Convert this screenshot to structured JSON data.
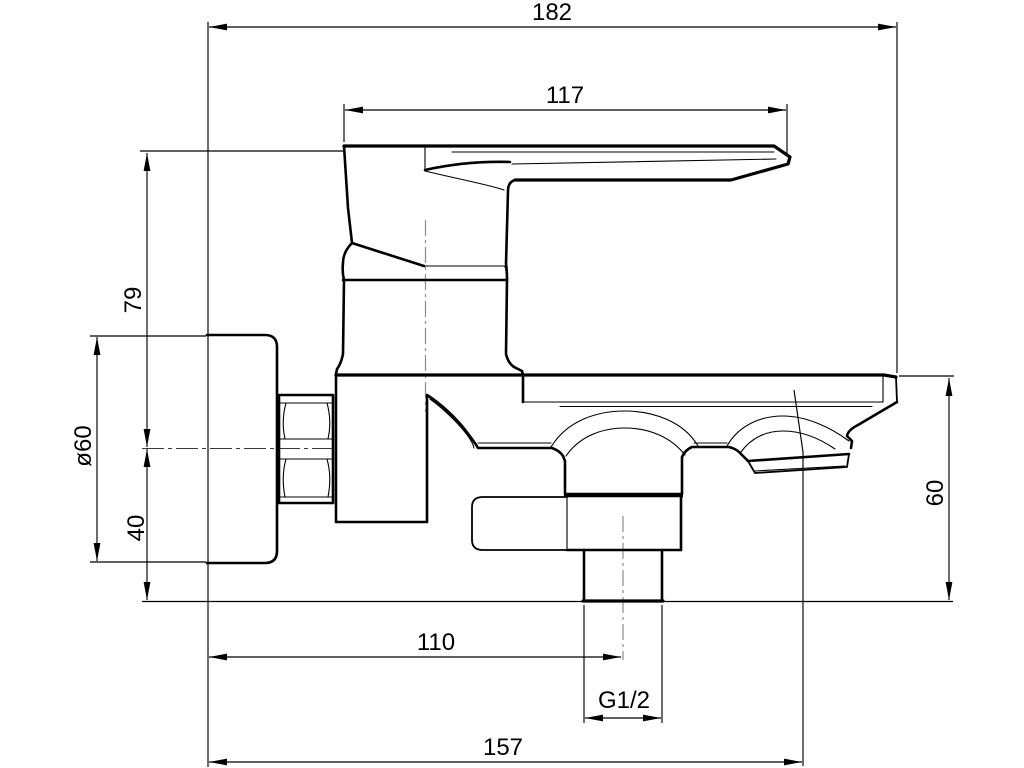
{
  "drawing": {
    "type": "technical-dimension-drawing",
    "subject": "wall-mounted single-lever bath mixer, side view",
    "units_shown": "mm",
    "dimensions": {
      "overall_reach": "182",
      "handle_length": "117",
      "handle_height_above_axis": "79",
      "wall_plate_diameter": "ø60",
      "axis_to_outlet_bottom": "40",
      "spout_top_to_outlet_bottom": "60",
      "wall_to_outlet_axis": "110",
      "connection_thread": "G1/2",
      "wall_to_spout_tip_axis": "157"
    },
    "colors": {
      "line": "#000000",
      "centerline": "#8c8c8c",
      "background": "#ffffff"
    }
  }
}
